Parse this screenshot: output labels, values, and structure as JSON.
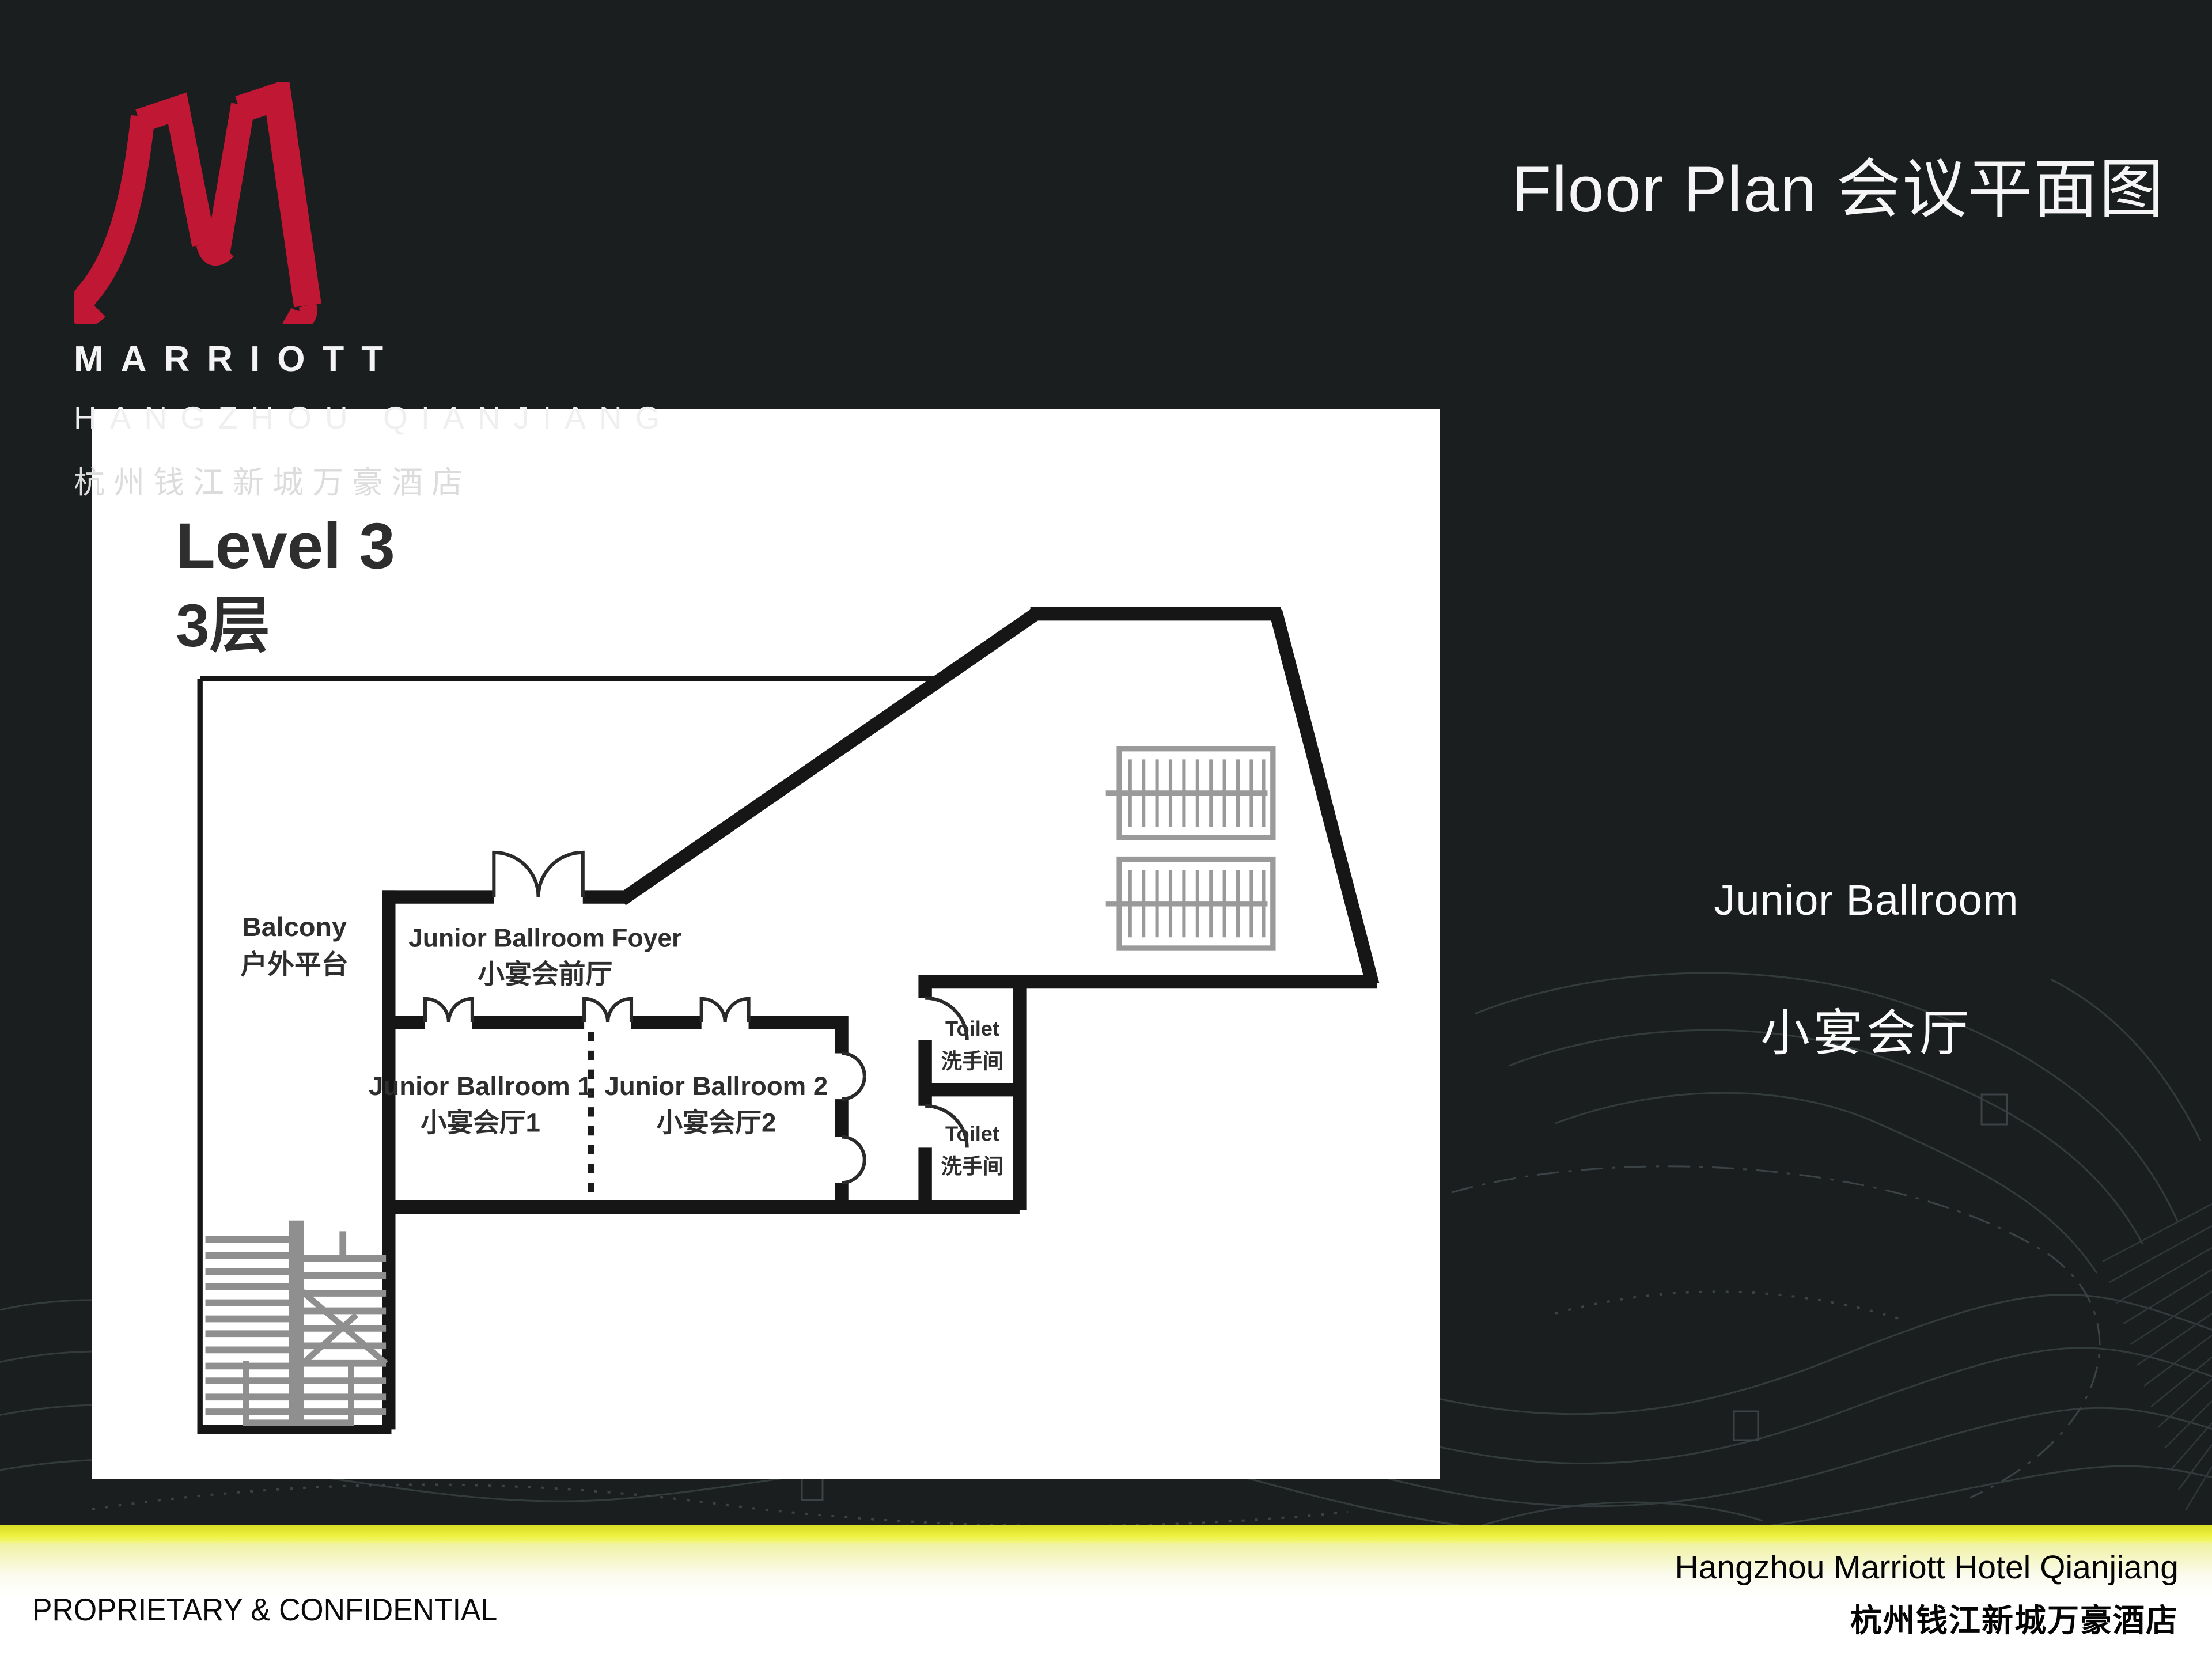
{
  "colors": {
    "background": "#1b1e1f",
    "contour_line": "#363d3f",
    "accent_red": "#c01734",
    "accent_yellow": "#e9ec3a",
    "panel": "#ffffff",
    "wall_black": "#161616",
    "plan_gray": "#8f8f8f",
    "plan_text": "#2e2e2e"
  },
  "brand": {
    "logo_icon": "marriott-m-icon",
    "name_line1": "MARRIOTT",
    "name_line2": "HANGZHOU QIANJIANG",
    "name_line3": "杭州钱江新城万豪酒店"
  },
  "title": "Floor Plan 会议平面图",
  "plan": {
    "level_en": "Level 3",
    "level_cn": "3层",
    "foyer_en": "Junior Ballroom Foyer",
    "foyer_cn": "小宴会前厅",
    "balcony_en": "Balcony",
    "balcony_cn": "户外平台",
    "ballroom1_en": "Junior Ballroom 1",
    "ballroom1_cn": "小宴会厅1",
    "ballroom2_en": "Junior Ballroom 2",
    "ballroom2_cn": "小宴会厅2",
    "toilet_en": "Toilet",
    "toilet_cn": "洗手间"
  },
  "highlight": {
    "en": "Junior Ballroom",
    "cn": "小宴会厅"
  },
  "footer": {
    "left": "PROPRIETARY & CONFIDENTIAL",
    "right_line1": "Hangzhou Marriott Hotel Qianjiang",
    "right_line2": "杭州钱江新城万豪酒店"
  }
}
